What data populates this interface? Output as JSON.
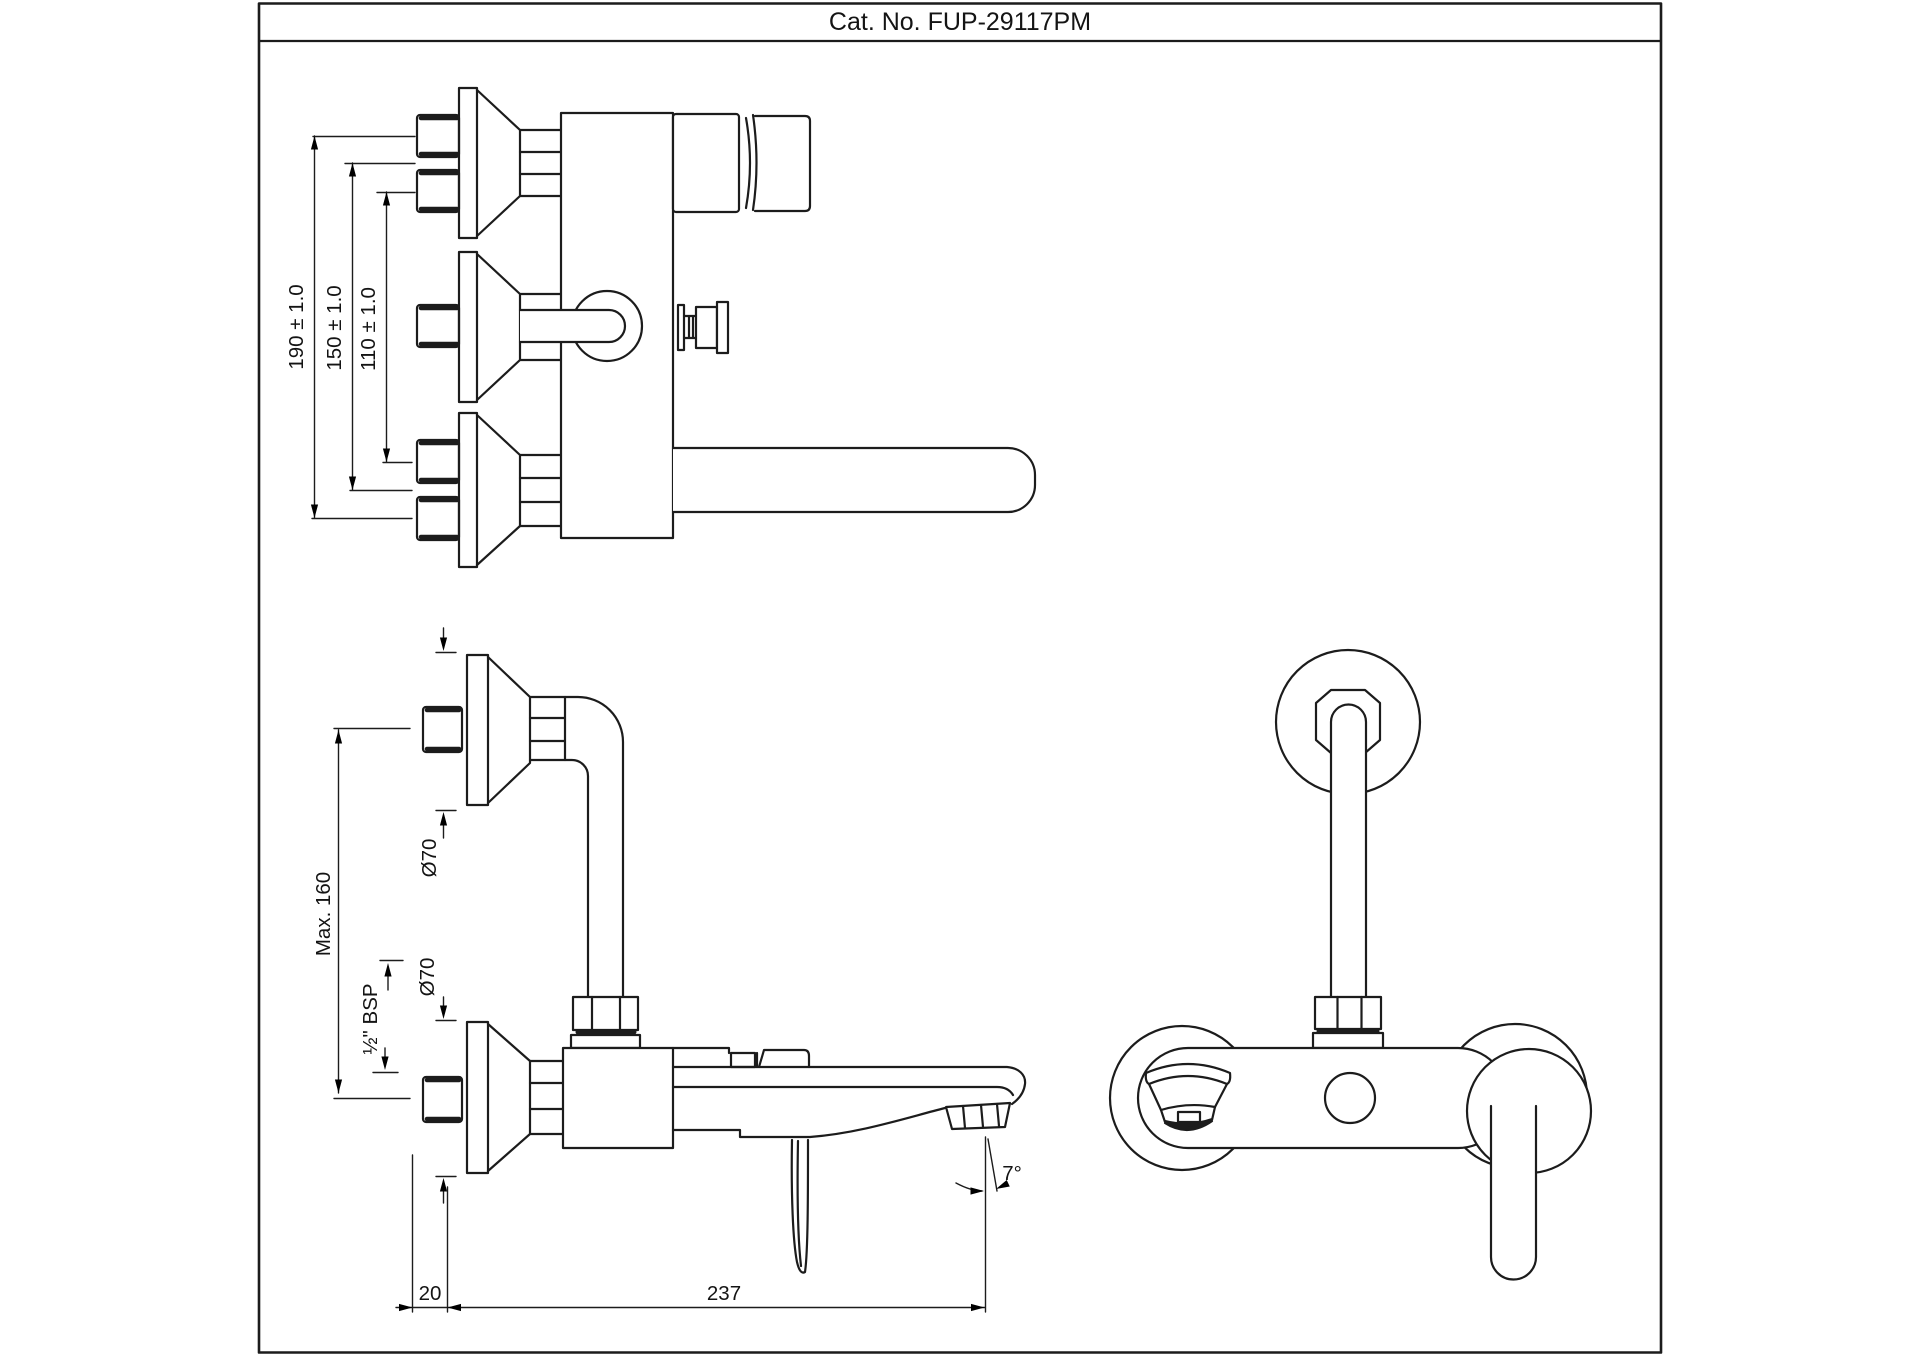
{
  "title_block": {
    "catalog_label": "Cat. No. FUP-29117PM"
  },
  "colors": {
    "line": "#1c1c1c",
    "background": "#ffffff"
  },
  "views": {
    "top_view": {
      "dimensions": {
        "hole_spacing_outer": "190 ± 1.0",
        "hole_spacing_middle": "150 ± 1.0",
        "hole_spacing_inner": "110 ± 1.0"
      }
    },
    "side_view": {
      "dimensions": {
        "max_projection": "Max. 160",
        "flange_diameter_upper": "Ø70",
        "flange_diameter_lower": "Ø70",
        "inlet_thread": "½\" BSP",
        "wall_clearance": "20",
        "spout_reach": "237",
        "spout_angle": "7°"
      }
    },
    "front_view": {}
  }
}
